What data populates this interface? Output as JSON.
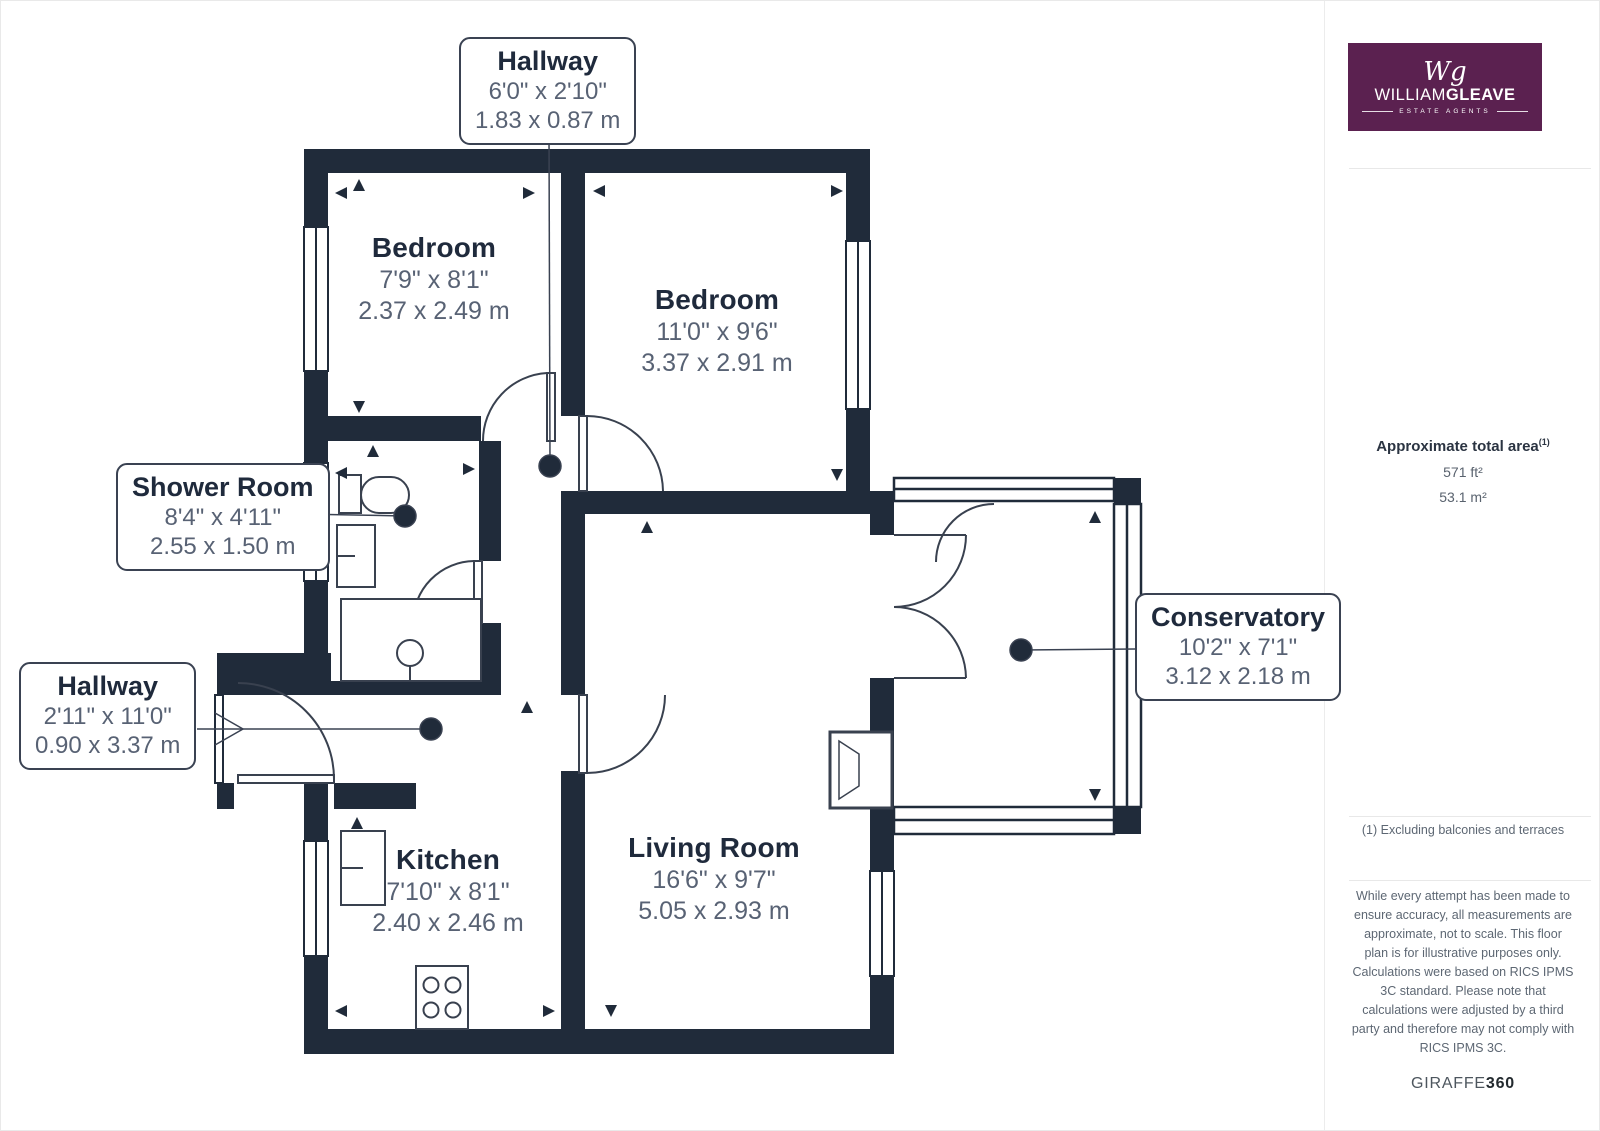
{
  "plan": {
    "rooms": {
      "bedroom1": {
        "name": "Bedroom",
        "imperial": "7'9\" x 8'1\"",
        "metric": "2.37 x 2.49 m"
      },
      "bedroom2": {
        "name": "Bedroom",
        "imperial": "11'0\" x 9'6\"",
        "metric": "3.37 x 2.91 m"
      },
      "kitchen": {
        "name": "Kitchen",
        "imperial": "7'10\" x 8'1\"",
        "metric": "2.40 x 2.46 m"
      },
      "living_room": {
        "name": "Living Room",
        "imperial": "16'6\" x 9'7\"",
        "metric": "5.05 x 2.93 m"
      }
    },
    "callouts": {
      "hallway_top": {
        "name": "Hallway",
        "imperial": "6'0\" x 2'10\"",
        "metric": "1.83 x 0.87 m"
      },
      "shower_room": {
        "name": "Shower Room",
        "imperial": "8'4\" x 4'11\"",
        "metric": "2.55 x 1.50 m"
      },
      "hallway_left": {
        "name": "Hallway",
        "imperial": "2'11\" x 11'0\"",
        "metric": "0.90 x 3.37 m"
      },
      "conservatory": {
        "name": "Conservatory",
        "imperial": "10'2\" x 7'1\"",
        "metric": "3.12 x 2.18 m"
      }
    }
  },
  "sidebar": {
    "logo": {
      "monogram": "Wg",
      "brand_light": "WILLIAM",
      "brand_bold": "GLEAVE",
      "tagline": "ESTATE AGENTS"
    },
    "area": {
      "title": "Approximate total area",
      "superscript": "(1)",
      "sqft": "571 ft²",
      "sqm": "53.1 m²"
    },
    "footnote": "(1) Excluding balconies and terraces",
    "disclaimer1": "While every attempt has been made to ensure accuracy, all measurements are approximate, not to scale. This floor plan is for illustrative purposes only.",
    "disclaimer2": "Calculations were based on RICS IPMS 3C standard. Please note that calculations were adjusted by a third party and therefore may not comply with RICS IPMS 3C.",
    "brand_footer_normal": "GIRAFFE",
    "brand_footer_bold": "360"
  },
  "colors": {
    "wall": "#202b3a",
    "logo_bg": "#5b2150",
    "leader": "#3a4252"
  }
}
